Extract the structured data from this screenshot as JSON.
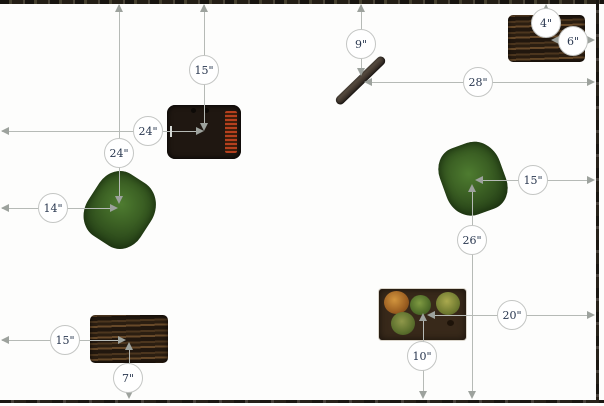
{
  "diagram": {
    "type": "garden-spacing-plan",
    "canvas": {
      "width": 604,
      "height": 406
    }
  },
  "colors": {
    "background": "#fdfdfc",
    "line": "#b6bab6",
    "arrow": "#9da29d",
    "badge_fill": "#ffffff",
    "badge_border": "#c4c6c4",
    "badge_text": "#2a3850",
    "border": "#211d16"
  },
  "measurements": [
    {
      "id": "flower-planter-from-top",
      "label": "15\""
    },
    {
      "id": "flower-planter-from-left",
      "label": "24\""
    },
    {
      "id": "bush-left-from-top",
      "label": "24\""
    },
    {
      "id": "bush-left-from-left",
      "label": "14\""
    },
    {
      "id": "log-from-top",
      "label": "9\""
    },
    {
      "id": "log-from-right",
      "label": "28\""
    },
    {
      "id": "raised-bed-top-right-from-top",
      "label": "4\""
    },
    {
      "id": "raised-bed-top-right-from-right",
      "label": "6\""
    },
    {
      "id": "bush-right-from-right",
      "label": "15\""
    },
    {
      "id": "bush-right-from-bottom",
      "label": "26\""
    },
    {
      "id": "cactus-bed-from-right",
      "label": "20\""
    },
    {
      "id": "cactus-bed-from-bottom",
      "label": "10\""
    },
    {
      "id": "raised-bed-bottom-left-from-left",
      "label": "15\""
    },
    {
      "id": "raised-bed-bottom-left-from-bottom",
      "label": "7\""
    }
  ],
  "objects": [
    {
      "id": "flower-planter",
      "name": "planter box with red flower rows and trellis"
    },
    {
      "id": "bush-left",
      "name": "green bush"
    },
    {
      "id": "log",
      "name": "diagonal log"
    },
    {
      "id": "raised-bed-top-right",
      "name": "wooden raised bed"
    },
    {
      "id": "bush-right",
      "name": "green bush"
    },
    {
      "id": "cactus-bed",
      "name": "bed with four round cacti"
    },
    {
      "id": "raised-bed-bottom-left",
      "name": "wooden raised bed"
    }
  ]
}
